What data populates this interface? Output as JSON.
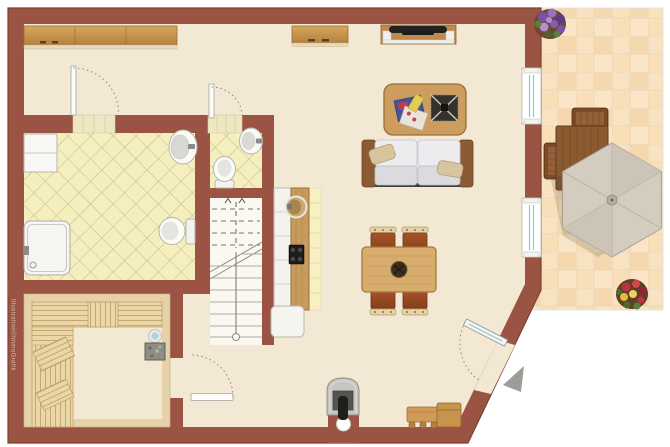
{
  "meta": {
    "type": "architectural-floor-plan",
    "watermark": "Illustration©ImmoGrafik"
  },
  "palette": {
    "wall": "#9B5343",
    "wall_outline": "#7E4030",
    "floor": "#F2E8D4",
    "bath_tile": "#F5EFBE",
    "tile_line": "#C6BB93",
    "patio_tile": "#F8DFB8",
    "patio_grout": "#EBD9BC",
    "wood": "#C89650",
    "wood_dark": "#8A5A30",
    "fixture_white": "#FAFAF7",
    "fixture_stroke": "#B5B5AE",
    "window_glass": "#8FC9DE",
    "sofa_cushion": "#ECECEE",
    "pillow_tan": "#D7C5A0",
    "chair_brown": "#A3512A",
    "umbrella": "#D4CDBF",
    "entrance_arrow": "#9C9C98",
    "stove_grey": "#C6C6C1",
    "sauna_heater_blue": "#A9D3E3",
    "flower_purple": "#8A5BB5",
    "flower_red": "#C23A4A",
    "flower_yellow": "#E8C24A"
  },
  "rooms": [
    {
      "id": "hallway",
      "name": "hallway"
    },
    {
      "id": "bathroom",
      "name": "bathroom with shower"
    },
    {
      "id": "wc",
      "name": "guest wc"
    },
    {
      "id": "staircase",
      "name": "staircase"
    },
    {
      "id": "kitchen",
      "name": "kitchenette"
    },
    {
      "id": "sauna",
      "name": "sauna"
    },
    {
      "id": "living-dining",
      "name": "living and dining room"
    },
    {
      "id": "patio",
      "name": "patio / terrace"
    }
  ],
  "objects": {
    "hall_sideboard": "long wood sideboard",
    "desk": "sideboard with drawers",
    "tv_unit": "tv lowboard with television",
    "coffee_table": "coffee table with magazines and bowl",
    "sofa": "two-seat sofa with pillows",
    "dining_table": "dining table with centerpiece",
    "dining_chairs": 4,
    "kitchen_sink": "round sink",
    "cooktop": "4-burner cooktop",
    "shower": "shower tray",
    "bath_sink": "washbasin",
    "toilet": "toilet",
    "wc_sink": "washbasin",
    "wc_toilet": "toilet",
    "sauna_benches": "wood benches",
    "sauna_heater": "sauna heater",
    "stove": "wood-burning stove with chimney",
    "entry_bench": "shoe bench",
    "entry_box": "storage chest",
    "patio_set": "outdoor table, chairs and parasol",
    "planters": [
      "purple flower planter",
      "red-yellow flower planter"
    ],
    "windows": 2,
    "doors": [
      "bathroom door",
      "wc door",
      "sauna door",
      "entrance door"
    ]
  }
}
